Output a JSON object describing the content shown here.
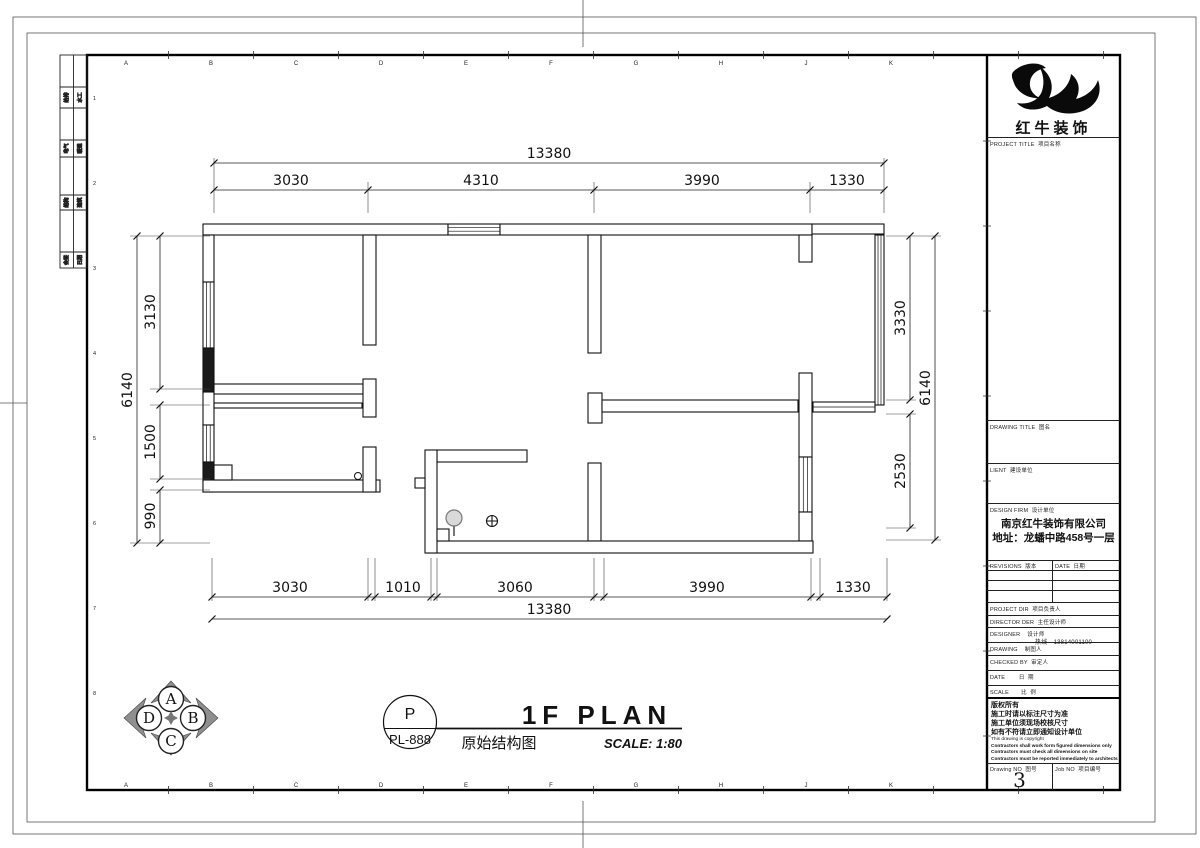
{
  "sheet": {
    "grid_letters": [
      "A",
      "B",
      "C",
      "D",
      "E",
      "F",
      "G",
      "H",
      "J",
      "K"
    ],
    "grid_numbers": [
      "1",
      "2",
      "3",
      "4",
      "5",
      "6",
      "7",
      "8"
    ],
    "strip": [
      {
        "a": "给排",
        "b": "水工"
      },
      {
        "a": "电气",
        "b": "暖通"
      },
      {
        "a": "结构",
        "b": "建筑"
      },
      {
        "a": "会签",
        "b": "日期"
      }
    ]
  },
  "plan": {
    "dims": {
      "top_total": "13380",
      "top": [
        "3030",
        "4310",
        "3990",
        "1330"
      ],
      "bottom": [
        "3030",
        "1010",
        "3060",
        "3990",
        "1330"
      ],
      "bottom_total": "13380",
      "left_outer": "6140",
      "left": [
        "3130",
        "1500",
        "990"
      ],
      "right": [
        "3330",
        "2530"
      ],
      "right_outer": "6140"
    },
    "compass": {
      "top": "A",
      "right": "B",
      "bottom": "C",
      "left": "D"
    },
    "titlebar": {
      "ref_top": "P",
      "ref_bottom": "PL-888",
      "title": "1F PLAN",
      "subtitle": "原始结构图",
      "scale": "SCALE: 1:80"
    }
  },
  "titleblock": {
    "logo_text": "红牛装饰",
    "project_title": "PROJECT TITLE  项目名称",
    "drawing_title": "DRAWING TITLE  图名",
    "client": "LIENT  建设单位",
    "design_firm": "DESIGN FIRM  设计单位",
    "firm_name": "南京红牛装饰有限公司",
    "firm_addr": "地址：龙蟠中路458号一层",
    "revisions": "REVISIONS  版本",
    "rev_date": "DATE  日期",
    "project_dir": "PROJECT DIR  项目负责人",
    "director": "DIRECTOR DER  主任设计师",
    "designer": "DESIGNER    设计师",
    "designer_phone": "热线—13814001100",
    "drawing_by": "DRAWING    制图人",
    "checked_by": "CHECKED BY  审定人",
    "date": "DATE        日  期",
    "scale": "SCALE       比  例",
    "copyright_cn": [
      "版权所有",
      "施工时请以标注尺寸为准",
      "施工单位须现场校核尺寸",
      "如有不符请立即通知设计单位"
    ],
    "copyright_en": [
      "This drawing is copyright",
      "Contractors shall work form figured dimensions only",
      "Contractors must check all dimensions on site",
      "Contractors must be reported immediately to architects"
    ],
    "drawing_no_label": "Drawing NO  图号",
    "drawing_no": "3",
    "job_no_label": "Job NO  项目编号"
  }
}
